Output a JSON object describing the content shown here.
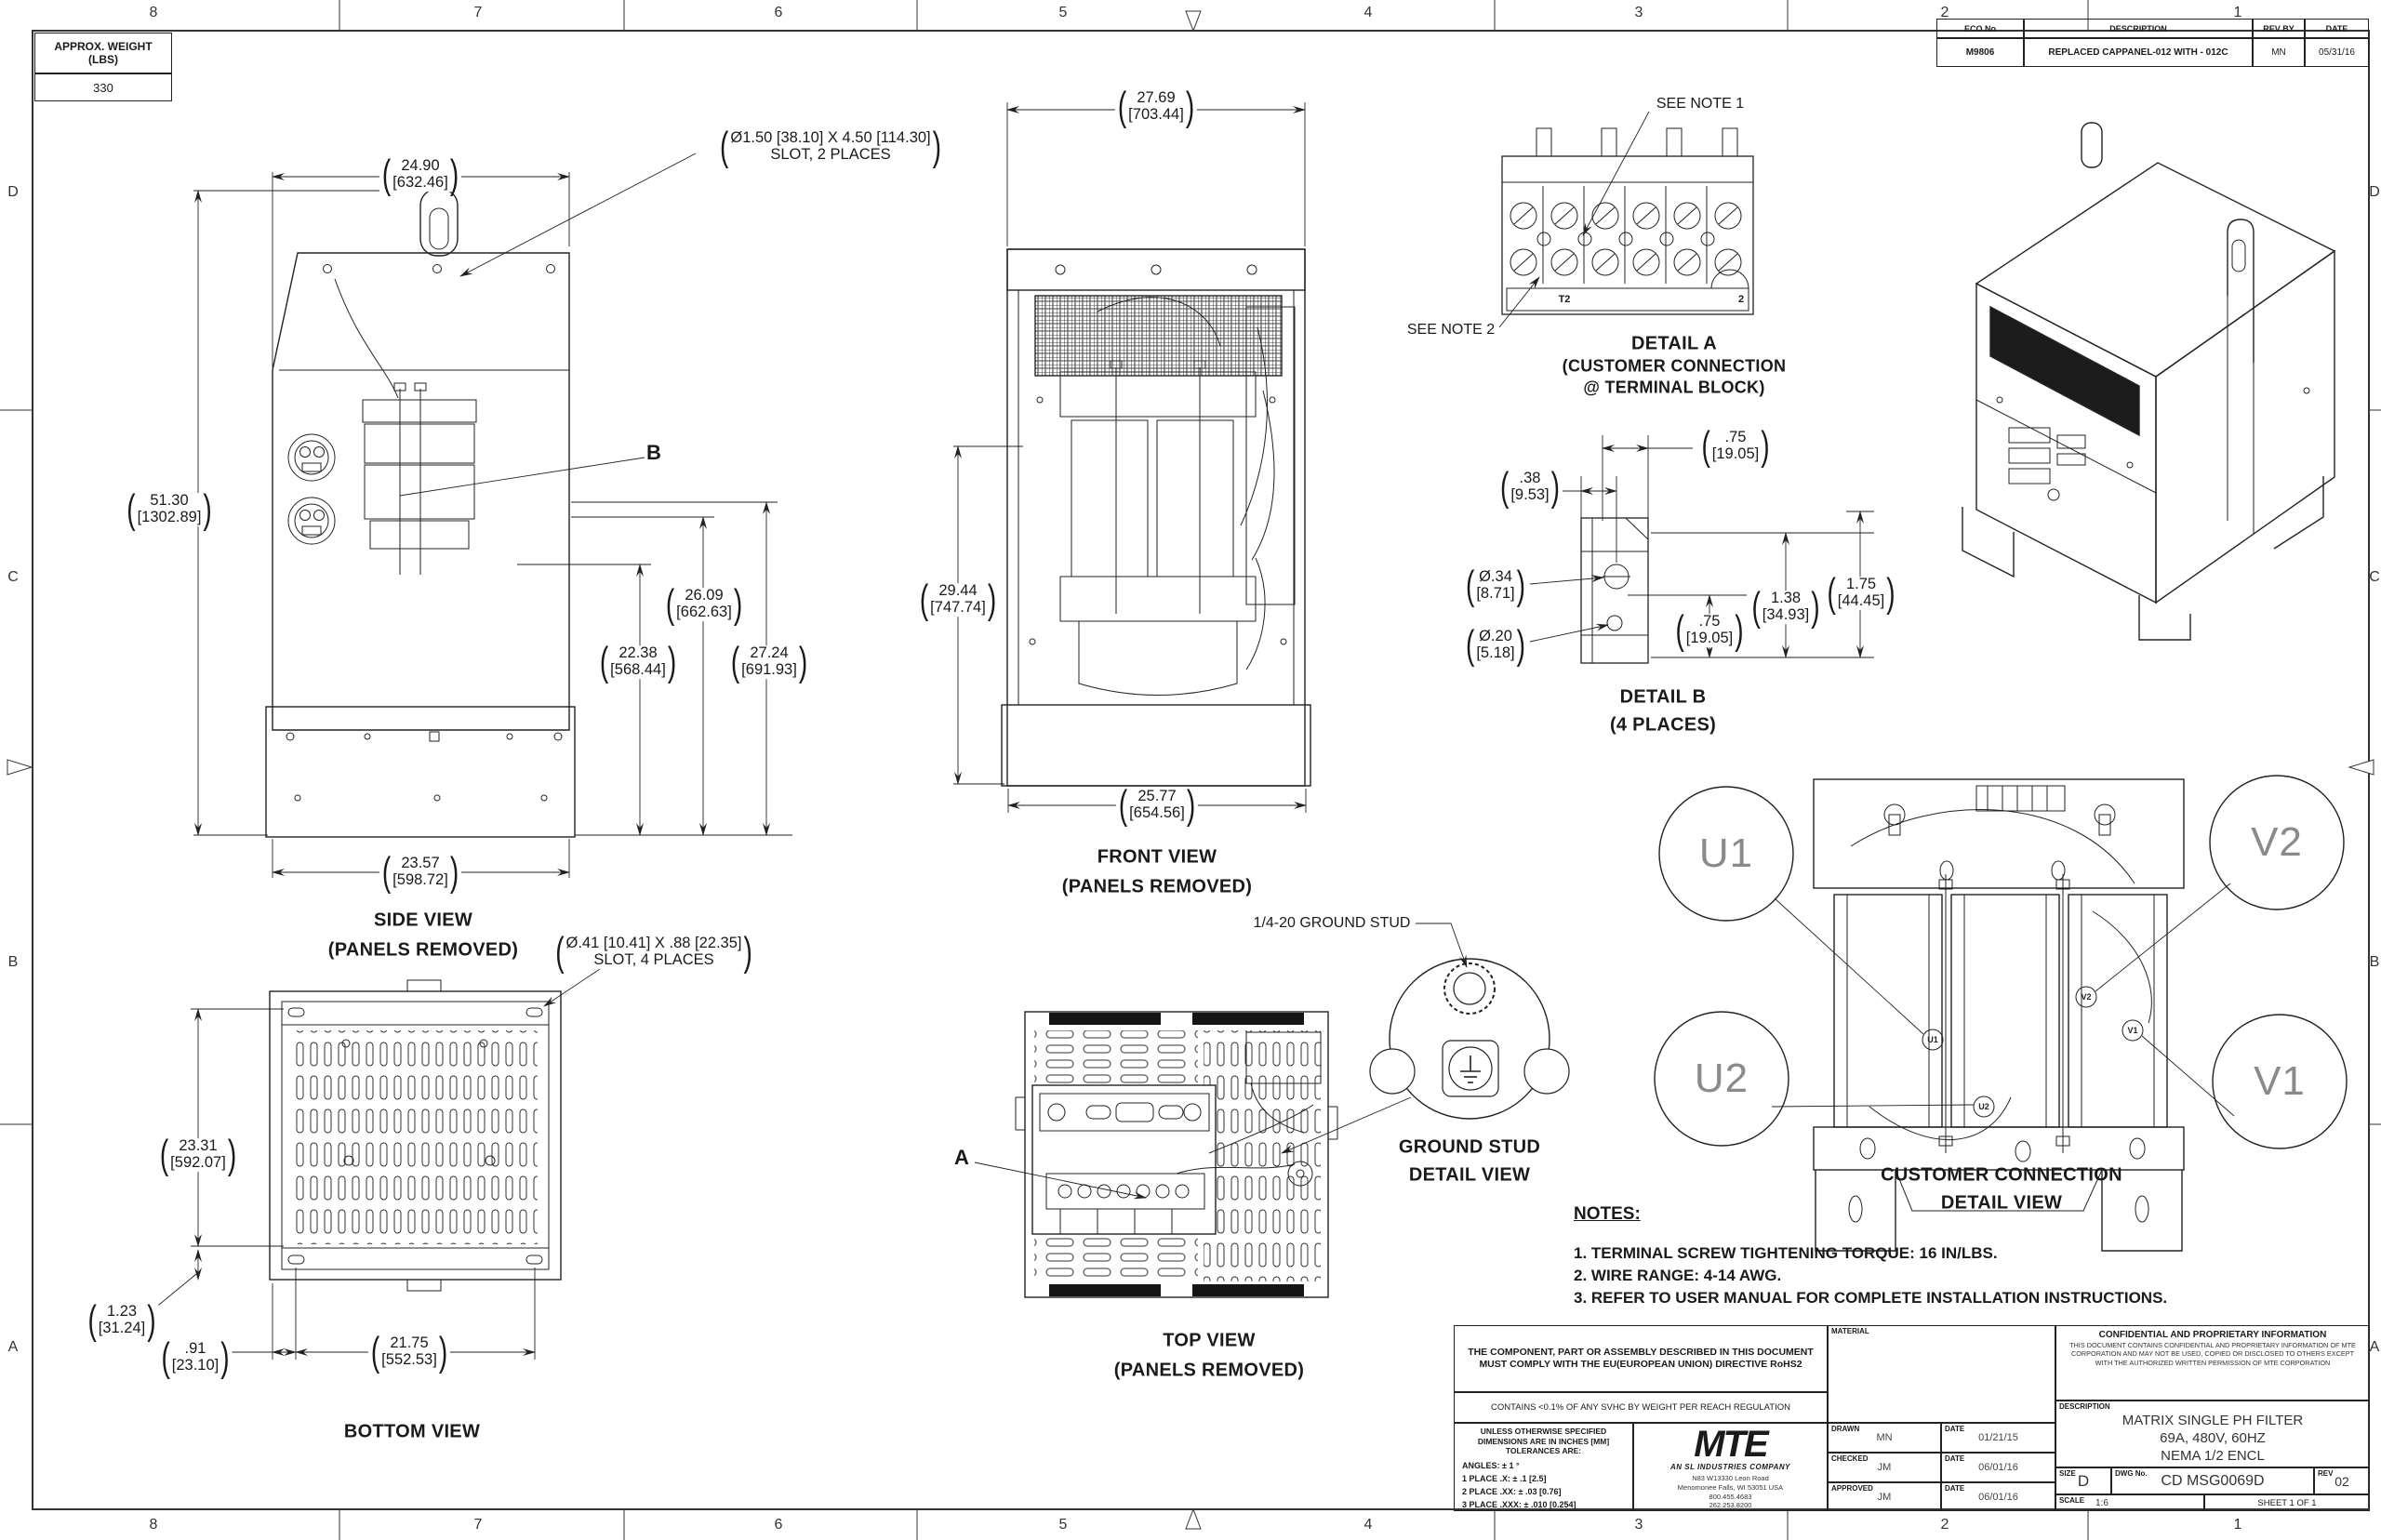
{
  "sheet": {
    "zones_h": [
      "8",
      "7",
      "6",
      "5",
      "4",
      "3",
      "2",
      "1"
    ],
    "zones_v": [
      "D",
      "C",
      "B",
      "A"
    ],
    "weight_table": {
      "header_line1": "APPROX. WEIGHT",
      "header_line2": "(LBS)",
      "value": "330"
    },
    "eco_table": {
      "headers": [
        "ECO No",
        "DESCRIPTION",
        "REV BY",
        "DATE"
      ],
      "row": [
        "M9806",
        "REPLACED CAPPANEL-012 WITH - 012C",
        "MN",
        "05/31/16"
      ]
    }
  },
  "views": {
    "side": {
      "title": "SIDE VIEW",
      "subtitle": "(PANELS REMOVED)",
      "balloon": "B",
      "slot_note_line1": "Ø1.50 [38.10] X 4.50 [114.30]",
      "slot_note_line2": "SLOT, 2 PLACES",
      "dims": {
        "width_top": {
          "in": "24.90",
          "mm": "[632.46]"
        },
        "height": {
          "in": "51.30",
          "mm": "[1302.89]"
        },
        "h1": {
          "in": "22.38",
          "mm": "[568.44]"
        },
        "h2": {
          "in": "26.09",
          "mm": "[662.63]"
        },
        "h3": {
          "in": "27.24",
          "mm": "[691.93]"
        },
        "width_bottom": {
          "in": "23.57",
          "mm": "[598.72]"
        }
      }
    },
    "front": {
      "title": "FRONT VIEW",
      "subtitle": "(PANELS REMOVED)",
      "dims": {
        "width_top": {
          "in": "27.69",
          "mm": "[703.44]"
        },
        "height": {
          "in": "29.44",
          "mm": "[747.74]"
        },
        "width_bottom": {
          "in": "25.77",
          "mm": "[654.56]"
        }
      }
    },
    "detail_a": {
      "see_note_1": "SEE NOTE 1",
      "see_note_2": "SEE NOTE 2",
      "title_line1": "DETAIL A",
      "title_line2": "(CUSTOMER CONNECTION",
      "title_line3": "@ TERMINAL BLOCK)",
      "strip_labels": [
        "T2",
        "2"
      ]
    },
    "detail_b": {
      "title_line1": "DETAIL B",
      "title_line2": "(4 PLACES)",
      "dims": {
        "d075t": {
          "in": ".75",
          "mm": "[19.05]"
        },
        "d038": {
          "in": ".38",
          "mm": "[9.53]"
        },
        "d034": {
          "in": "Ø.34",
          "mm": "[8.71]"
        },
        "d020": {
          "in": "Ø.20",
          "mm": "[5.18]"
        },
        "d075b": {
          "in": ".75",
          "mm": "[19.05]"
        },
        "d138": {
          "in": "1.38",
          "mm": "[34.93]"
        },
        "d175": {
          "in": "1.75",
          "mm": "[44.45]"
        }
      }
    },
    "bottom": {
      "title": "BOTTOM VIEW",
      "slot_note_line1": "Ø.41 [10.41] X .88 [22.35]",
      "slot_note_line2": "SLOT, 4 PLACES",
      "dims": {
        "height": {
          "in": "23.31",
          "mm": "[592.07]"
        },
        "d123": {
          "in": "1.23",
          "mm": "[31.24]"
        },
        "d091": {
          "in": ".91",
          "mm": "[23.10]"
        },
        "width": {
          "in": "21.75",
          "mm": "[552.53]"
        }
      }
    },
    "top": {
      "title": "TOP VIEW",
      "subtitle": "(PANELS REMOVED)",
      "balloon": "A"
    },
    "ground_stud": {
      "callout": "1/4-20 GROUND STUD",
      "title_line1": "GROUND STUD",
      "title_line2": "DETAIL VIEW"
    },
    "customer_connection": {
      "title_line1": "CUSTOMER CONNECTION",
      "title_line2": "DETAIL VIEW",
      "balloons": [
        "U1",
        "V2",
        "U2",
        "V1"
      ]
    }
  },
  "notes": {
    "heading": "NOTES:",
    "items": [
      "1.  TERMINAL SCREW TIGHTENING TORQUE: 16 IN/LBS.",
      "2.  WIRE RANGE: 4-14 AWG.",
      "3.  REFER TO USER MANUAL FOR COMPLETE INSTALLATION INSTRUCTIONS."
    ]
  },
  "title_block": {
    "rohs": "THE COMPONENT, PART OR ASSEMBLY DESCRIBED IN THIS DOCUMENT MUST COMPLY WITH THE EU(EUROPEAN UNION) DIRECTIVE RoHS2",
    "svhc": "CONTAINS <0.1% OF ANY SVHC BY WEIGHT PER REACH REGULATION",
    "tol_head1": "UNLESS OTHERWISE SPECIFIED",
    "tol_head2": "DIMENSIONS ARE IN INCHES [MM]",
    "tol_head3": "TOLERANCES ARE:",
    "tol_angles": "ANGLES: ± 1 °",
    "tol_1place": "1 PLACE .X: ± .1 [2.5]",
    "tol_2place": "2 PLACE .XX: ± .03 [0.76]",
    "tol_3place": "3 PLACE .XXX: ± .010 [0.254]",
    "logo_text": "MTE",
    "logo_sub": "AN SL INDUSTRIES COMPANY",
    "address1": "N83 W13330 Leon Road",
    "address2": "Menomonee Falls, WI 53051 USA",
    "address3": "800.455.4683",
    "address4": "262.253.8200",
    "material_label": "MATERIAL",
    "sign_rows": [
      {
        "role": "DRAWN",
        "name": "MN",
        "date_label": "DATE",
        "date": "01/21/15"
      },
      {
        "role": "CHECKED",
        "name": "JM",
        "date_label": "DATE",
        "date": "06/01/16"
      },
      {
        "role": "APPROVED",
        "name": "JM",
        "date_label": "DATE",
        "date": "06/01/16"
      }
    ],
    "confidential_heading": "CONFIDENTIAL AND PROPRIETARY INFORMATION",
    "confidential_body": "THIS DOCUMENT CONTAINS CONFIDENTIAL AND PROPRIETARY INFORMATION OF MTE CORPORATION AND MAY NOT BE USED, COPIED OR DISCLOSED TO OTHERS EXCEPT WITH THE AUTHORIZED WRITTEN PERMISSION OF MTE CORPORATION",
    "description_label": "DESCRIPTION",
    "description_line1": "MATRIX SINGLE PH FILTER",
    "description_line2": "69A, 480V, 60HZ",
    "description_line3": "NEMA 1/2 ENCL",
    "size_label": "SIZE",
    "size": "D",
    "dwg_label": "DWG No.",
    "dwg": "CD MSG0069D",
    "rev_label": "REV",
    "rev": "02",
    "scale_label": "SCALE",
    "scale": "1:6",
    "sheet_text": "SHEET 1  OF 1"
  }
}
